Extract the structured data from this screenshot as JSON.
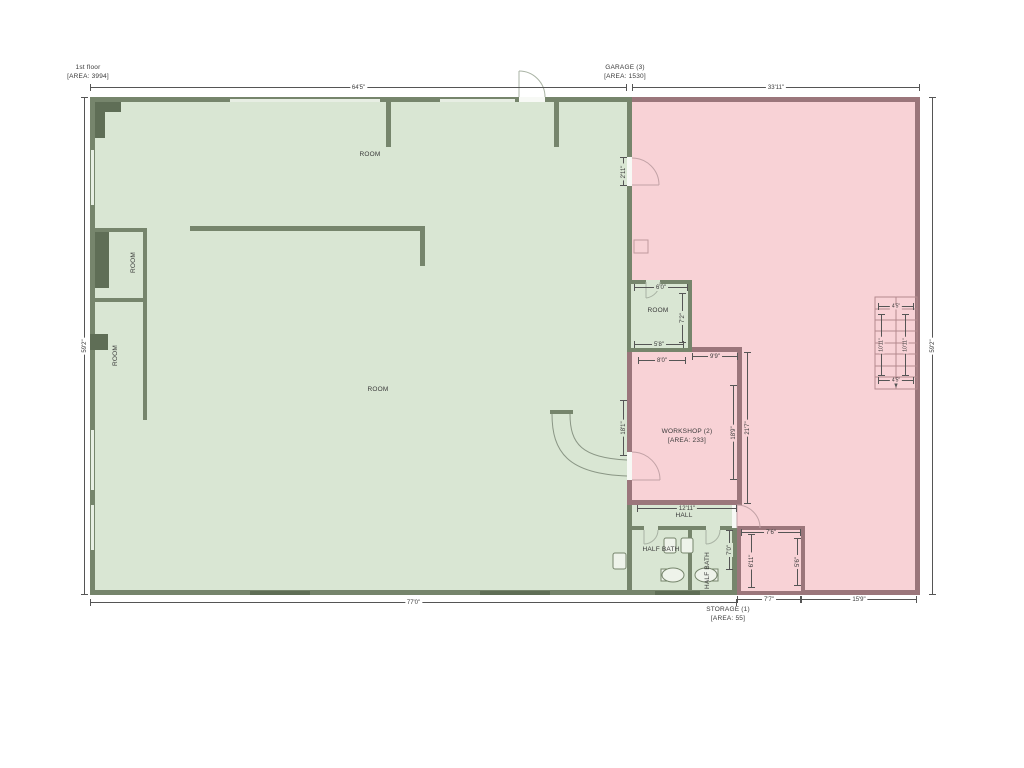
{
  "floor": {
    "name": "1st floor",
    "area": "[AREA: 3994]"
  },
  "garage": {
    "name": "GARAGE (3)",
    "area": "[AREA: 1530]"
  },
  "workshop": {
    "name": "WORKSHOP (2)",
    "area": "[AREA: 233]"
  },
  "storage": {
    "name": "STORAGE (1)",
    "area": "[AREA: 55]"
  },
  "hall": {
    "name": "HALL"
  },
  "bath1": {
    "name": "HALF BATH"
  },
  "bath2": {
    "name": "HALF BATH"
  },
  "rooms": [
    "ROOM",
    "ROOM",
    "ROOM",
    "ROOM",
    "ROOM"
  ],
  "dims": {
    "floor_width_top": "64'5\"",
    "garage_width_top": "33'11\"",
    "height_left": "59'2\"",
    "height_right": "59'2\"",
    "floor_width_bottom": "77'0\"",
    "storage_width_bottom": "7'7\"",
    "garage_width_bottom": "15'9\"",
    "small_room_width_top": "6'0\"",
    "small_room_height": "7'2\"",
    "small_room_width_bottom": "5'8\"",
    "workshop_width_top_left": "8'0\"",
    "workshop_width_top_right": "9'9\"",
    "workshop_height_left": "18'1\"",
    "workshop_height_right": "18'9\"",
    "workshop_height_outer": "21'7\"",
    "workshop_width_bottom": "12'11\"",
    "garage_door_height": "2'11\"",
    "hall_height_right": "7'0\"",
    "storage_width_top": "7'6\"",
    "storage_height_left": "6'11\"",
    "storage_height_right": "5'6\"",
    "stairs_width_top": "4'5\"",
    "stairs_width_bottom": "4'5\"",
    "stairs_height_left": "10'11\"",
    "stairs_height_right": "10'11\""
  },
  "colors": {
    "floor_fill": "#d9e6d3",
    "floor_wall": "#76856c",
    "floor_wall_dark": "#5f6e56",
    "garage_fill": "#f8d2d6",
    "garage_wall": "#9b767b",
    "window_fill": "#e7eee3",
    "dim_line": "#555555"
  }
}
